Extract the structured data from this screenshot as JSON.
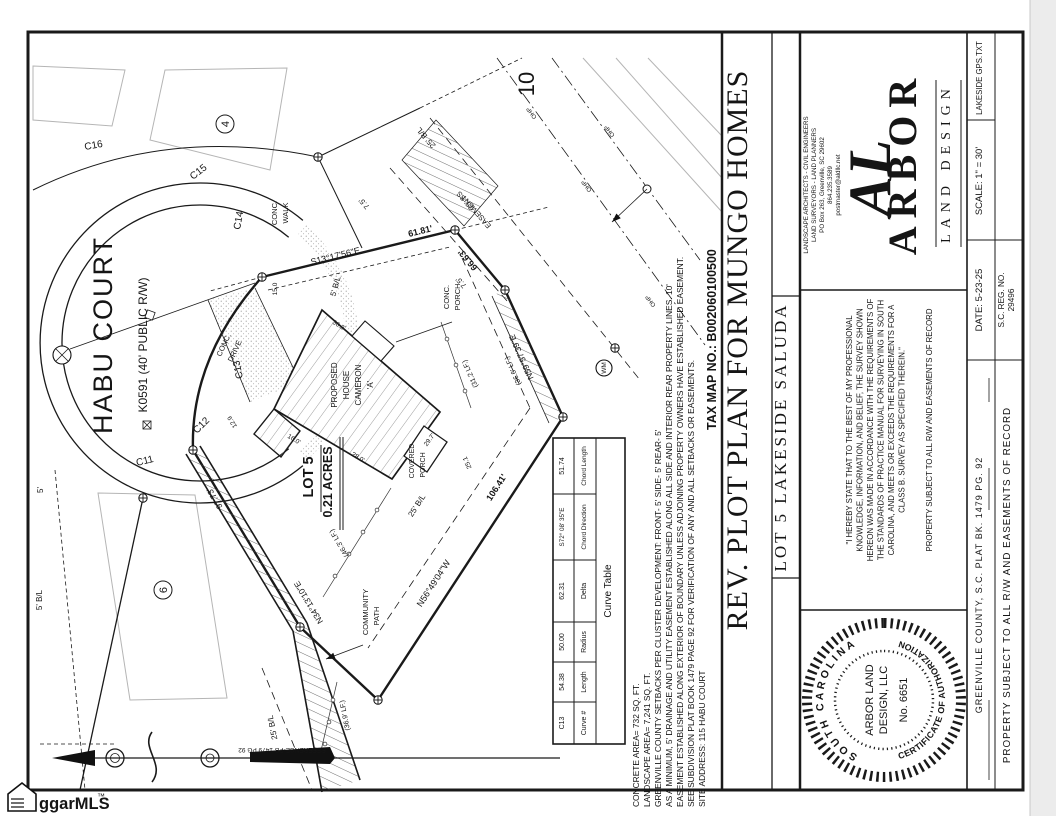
{
  "colors": {
    "ink": "#1a1a1a",
    "muted": "#b5b5b5",
    "scan_edge": "#ececec"
  },
  "watermark": {
    "text": "ggarMLS",
    "tm": "™"
  },
  "drawing": {
    "street": {
      "name": "HABU COURT",
      "designation": "K0591 (40' PUBLIC R/W)"
    },
    "curves": {
      "c11": "C11",
      "c12": "C12",
      "c13": "C13",
      "c14": "C14",
      "c15": "C15",
      "c16": "C16"
    },
    "lots": {
      "lot4": "4",
      "lot6": "6",
      "lot10": "10",
      "lot5_name": "LOT 5",
      "lot5_area": "0.21 ACRES"
    },
    "house": {
      "l1": "PROPOSED",
      "l2": "HOUSE",
      "l3": "CAMERON",
      "l4": "'A'"
    },
    "features": {
      "conc_walk_1": "CONC.",
      "conc_walk_2": "WALK",
      "conc_drive_1": "CONC.",
      "conc_drive_2": "DRIVE",
      "conc_porch_1": "CONC.",
      "conc_porch_2": "PORCH",
      "covered_porch_1": "COVERED",
      "covered_porch_2": "PORCH",
      "community_path_1": "COMMUNITY",
      "community_path_2": "PATH",
      "wm": "WM",
      "ohp": "OHP"
    },
    "bearings": {
      "north_line_bearing": "S13°17'56\"E",
      "north_line_dist": "61.81'",
      "east_corner_dist": "66.63'",
      "east_line_bearing": "N59°57'39\"E",
      "rear_line_dist": "106.41'",
      "rear_line_bearing": "N56°49'04\"W",
      "path_bearing": "N34°13'10\"E",
      "path_dist": "97.73'"
    },
    "linear_feet": {
      "lf1": "(31.2 LF.)",
      "lf2": "(36.6' LF.)",
      "lf3": "(46.3' LF.)",
      "lf4": "(36.9' LF.)"
    },
    "setbacks": {
      "bl25": "25' B/L",
      "bl5": "5' B/L",
      "bl75": "7.5'",
      "five": "5'",
      "ss1": "25' SS",
      "ss2": "EASEMENT"
    },
    "dims": {
      "d1": "15.0",
      "d2": "12.9",
      "d3": "25.1",
      "d4": "16.0'",
      "d5": "28.0'",
      "d6": "29.7'",
      "d7": "36.3'"
    },
    "reference": "REFERENCE-PB 1479 PG 92"
  },
  "notes": {
    "lines": [
      "CONCRETE AREA= 732 SQ. FT.",
      "LANDSCAPE AREA= 7,241 SQ. FT.",
      "GREENVILLE COUNTY SETBACKS PER CLUSTER DEVELOPMENT: FRONT- 5'  SIDE- 5'  REAR- 5'",
      "AS A MINIMUM, 5' DRAINAGE AND UTILITY EASEMENT ESTABLISHED ALONG ALL SIDE AND INTERIOR REAR PROPERTY LINES. 10'",
      "EASEMENT ESTABLISHED ALONG EXTERIOR OF BOUNDARY UNLESS ADJOINING PROPERTY OWNERS HAVE ESTABLISHED EASEMENT.",
      "SEE SUBDIVISION PLAT BOOK 1479 PAGE 92 FOR VERIFICATION OF ANY AND ALL SETBACKS OR EASEMENTS.",
      "SITE ADDRESS: 115 HABU COURT"
    ],
    "tax_map": "TAX MAP NO.: B002060100500"
  },
  "curve_table": {
    "title": "Curve Table",
    "headers": {
      "curve": "Curve #",
      "length": "Length",
      "radius": "Radius",
      "delta": "Delta",
      "chord_dir": "Chord Direction",
      "chord_len": "Chord Length"
    },
    "row": {
      "curve": "C13",
      "length": "54.38",
      "radius": "50.00",
      "delta": "62.31",
      "chord_dir": "S72° 08' 35\"E",
      "chord_len": "51.74"
    }
  },
  "title_block": {
    "title": "REV. PLOT PLAN FOR MUNGO HOMES",
    "subtitle": "LOT 5 LAKESIDE SALUDA",
    "firm": {
      "monogram": "AL",
      "name": "ARBOR",
      "tagline": "LAND DESIGN",
      "contact": [
        "LANDSCAPE ARCHITECTS - CIVIL ENGINEERS",
        "LAND SURVEYORS - LAND PLANNERS",
        "PO Box 263, Greenville, SC 29602",
        "864.235.3589",
        "postmaster@aldllc.net"
      ]
    },
    "file_ref": "LAKESIDE GPS.TXT",
    "scale": "SCALE: 1\" = 30'",
    "date": "DATE: 5-23-25",
    "reg_1": "S.C. REG. NO.",
    "reg_2": "29496",
    "county": "GREENVILLE      COUNTY, S.C.        PLAT BK.  1479        PG.  92",
    "subject": "PROPERTY SUBJECT TO ALL R/W AND EASEMENTS OF RECORD",
    "certification": {
      "lines": [
        "\"I HEREBY STATE THAT TO THE BEST OF MY PROFESSIONAL",
        "KNOWLEDGE, INFORMATION, AND BELIEF, THE SURVEY SHOWN",
        "HEREON WAS MADE IN ACCORDANCE WITH THE REQUIREMENTS OF",
        "THE STANDARDS OF PRACTICE MANUAL FOR SURVEYING IN SOUTH",
        "CAROLINA, AND MEETS OR EXCEEDS THE REQUIREMENTS FOR A",
        "CLASS B. SURVEY AS SPECIFIED THEREIN.\"",
        "PROPERTY SUBJECT TO ALL R/W AND EASEMENTS OF RECORD"
      ]
    },
    "seal": {
      "arc_top": "SOUTH CAROLINA",
      "arc_bottom": "CERTIFICATE OF AUTHORIZATION",
      "center": [
        "ARBOR LAND",
        "DESIGN, LLC",
        "No. 6651"
      ]
    }
  }
}
